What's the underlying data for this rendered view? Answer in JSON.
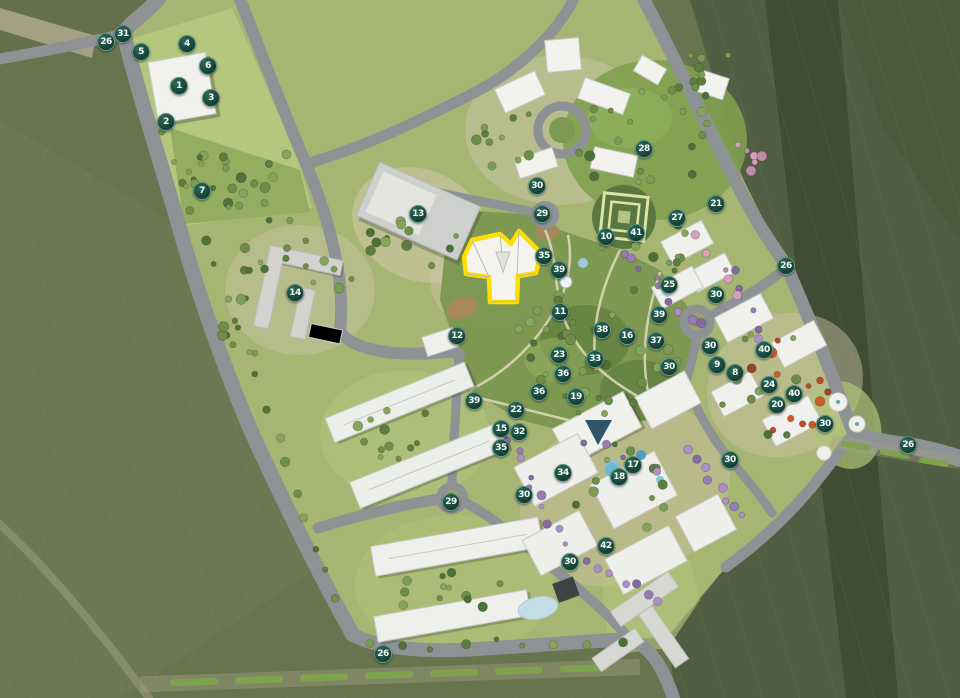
{
  "plan": {
    "colors": {
      "field_green": "#6a7650",
      "dark_belt_green": "#3d4b33",
      "site_green": "#a7b573",
      "road_gray": "#8f9295",
      "marker_bg": "#14463c",
      "marker_text": "#f2f7f3",
      "highlight_outline": "#ffdf00",
      "purple_tree": "#997bb4",
      "red_tree": "#b84a2e",
      "water_blue": "#bcd9e2"
    },
    "highlighted_building": {
      "outline_color": "#ffdf00",
      "shape": "three-wing-star"
    },
    "markers": [
      {
        "n": "31",
        "x": 123,
        "y": 34
      },
      {
        "n": "26",
        "x": 106,
        "y": 42
      },
      {
        "n": "5",
        "x": 141,
        "y": 52
      },
      {
        "n": "4",
        "x": 187,
        "y": 44
      },
      {
        "n": "6",
        "x": 208,
        "y": 66
      },
      {
        "n": "1",
        "x": 179,
        "y": 86
      },
      {
        "n": "3",
        "x": 211,
        "y": 98
      },
      {
        "n": "2",
        "x": 166,
        "y": 122
      },
      {
        "n": "7",
        "x": 202,
        "y": 191
      },
      {
        "n": "13",
        "x": 418,
        "y": 214
      },
      {
        "n": "14",
        "x": 295,
        "y": 293
      },
      {
        "n": "12",
        "x": 457,
        "y": 336
      },
      {
        "n": "30",
        "x": 537,
        "y": 186
      },
      {
        "n": "29",
        "x": 542,
        "y": 214
      },
      {
        "n": "28",
        "x": 644,
        "y": 149
      },
      {
        "n": "10",
        "x": 606,
        "y": 237
      },
      {
        "n": "41",
        "x": 636,
        "y": 233
      },
      {
        "n": "27",
        "x": 677,
        "y": 218
      },
      {
        "n": "21",
        "x": 716,
        "y": 204
      },
      {
        "n": "26",
        "x": 786,
        "y": 266
      },
      {
        "n": "25",
        "x": 669,
        "y": 285
      },
      {
        "n": "30",
        "x": 716,
        "y": 295
      },
      {
        "n": "35",
        "x": 544,
        "y": 256
      },
      {
        "n": "39",
        "x": 559,
        "y": 270
      },
      {
        "n": "11",
        "x": 560,
        "y": 312
      },
      {
        "n": "39",
        "x": 659,
        "y": 315
      },
      {
        "n": "38",
        "x": 602,
        "y": 330
      },
      {
        "n": "16",
        "x": 627,
        "y": 336
      },
      {
        "n": "37",
        "x": 656,
        "y": 341
      },
      {
        "n": "30",
        "x": 710,
        "y": 346
      },
      {
        "n": "40",
        "x": 764,
        "y": 350
      },
      {
        "n": "23",
        "x": 559,
        "y": 355
      },
      {
        "n": "33",
        "x": 595,
        "y": 359
      },
      {
        "n": "9",
        "x": 717,
        "y": 365
      },
      {
        "n": "30",
        "x": 669,
        "y": 367
      },
      {
        "n": "8",
        "x": 735,
        "y": 373
      },
      {
        "n": "36",
        "x": 563,
        "y": 374
      },
      {
        "n": "24",
        "x": 769,
        "y": 385
      },
      {
        "n": "36",
        "x": 539,
        "y": 392
      },
      {
        "n": "40",
        "x": 794,
        "y": 394
      },
      {
        "n": "19",
        "x": 576,
        "y": 397
      },
      {
        "n": "39",
        "x": 474,
        "y": 401
      },
      {
        "n": "20",
        "x": 777,
        "y": 405
      },
      {
        "n": "22",
        "x": 516,
        "y": 410
      },
      {
        "n": "30",
        "x": 825,
        "y": 424
      },
      {
        "n": "15",
        "x": 501,
        "y": 429
      },
      {
        "n": "32",
        "x": 519,
        "y": 432
      },
      {
        "n": "26",
        "x": 908,
        "y": 445
      },
      {
        "n": "35",
        "x": 501,
        "y": 448
      },
      {
        "n": "30",
        "x": 730,
        "y": 460
      },
      {
        "n": "17",
        "x": 633,
        "y": 465
      },
      {
        "n": "34",
        "x": 563,
        "y": 473
      },
      {
        "n": "18",
        "x": 619,
        "y": 477
      },
      {
        "n": "30",
        "x": 524,
        "y": 495
      },
      {
        "n": "29",
        "x": 451,
        "y": 502
      },
      {
        "n": "42",
        "x": 606,
        "y": 546
      },
      {
        "n": "30",
        "x": 570,
        "y": 562
      },
      {
        "n": "26",
        "x": 383,
        "y": 654
      }
    ]
  }
}
